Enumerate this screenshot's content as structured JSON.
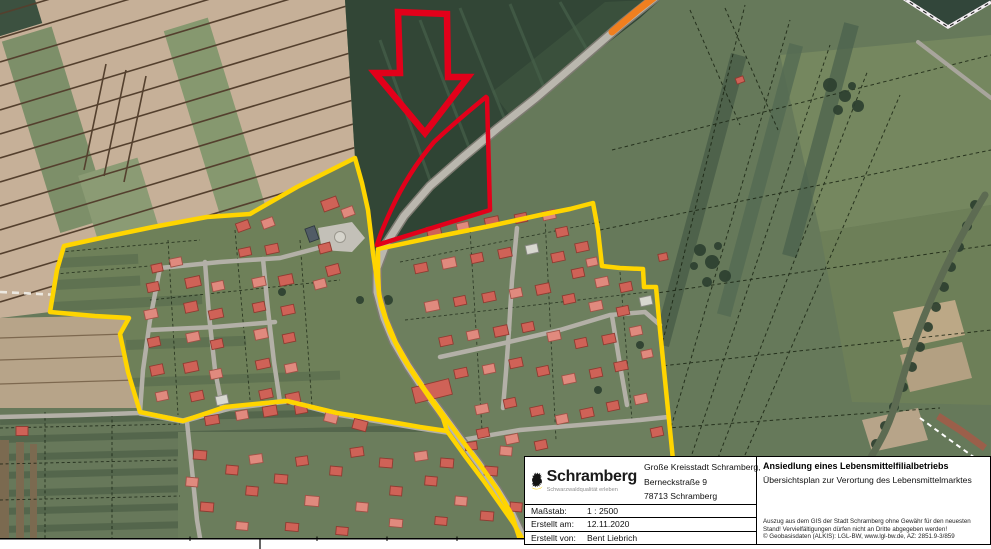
{
  "map": {
    "type": "aerial-gis-plan",
    "colors": {
      "boundary_yellow": "#FFD500",
      "site_outline_red": "#E2001A",
      "road_construction_orange": "#F07F1F"
    },
    "annotations": {
      "arrow": "red outline arrow pointing at planned site",
      "site": "red outlined parcel for Lebensmittelmarkt",
      "boundaries": "yellow settlement boundaries of two village areas"
    }
  },
  "info_box": {
    "logo": {
      "name": "Schramberg",
      "tagline": "Schwarzwaldqualität erleben"
    },
    "address": {
      "line1": "Große Kreisstadt Schramberg,",
      "line2": "Berneckstraße 9",
      "line3": "78713 Schramberg"
    },
    "title": "Ansiedlung eines Lebensmittelfilialbetriebs",
    "subtitle": "Übersichtsplan zur Verortung des Lebensmittelmarktes",
    "fields": [
      {
        "label": "Maßstab:",
        "value": "1 : 2500"
      },
      {
        "label": "Erstellt am:",
        "value": "12.11.2020"
      },
      {
        "label": "Erstellt von:",
        "value": "Bent Liebrich"
      }
    ],
    "disclaimer": [
      "Auszug aus dem GIS der Stadt Schramberg ohne Gewähr für den neuesten",
      "Stand! Vervielfältigungen dürfen nicht an Dritte abgegeben werden!",
      "© Geobasisdaten (ALKIS): LGL-BW, www.lgl-bw.de, AZ: 2851.9-3/859"
    ]
  }
}
